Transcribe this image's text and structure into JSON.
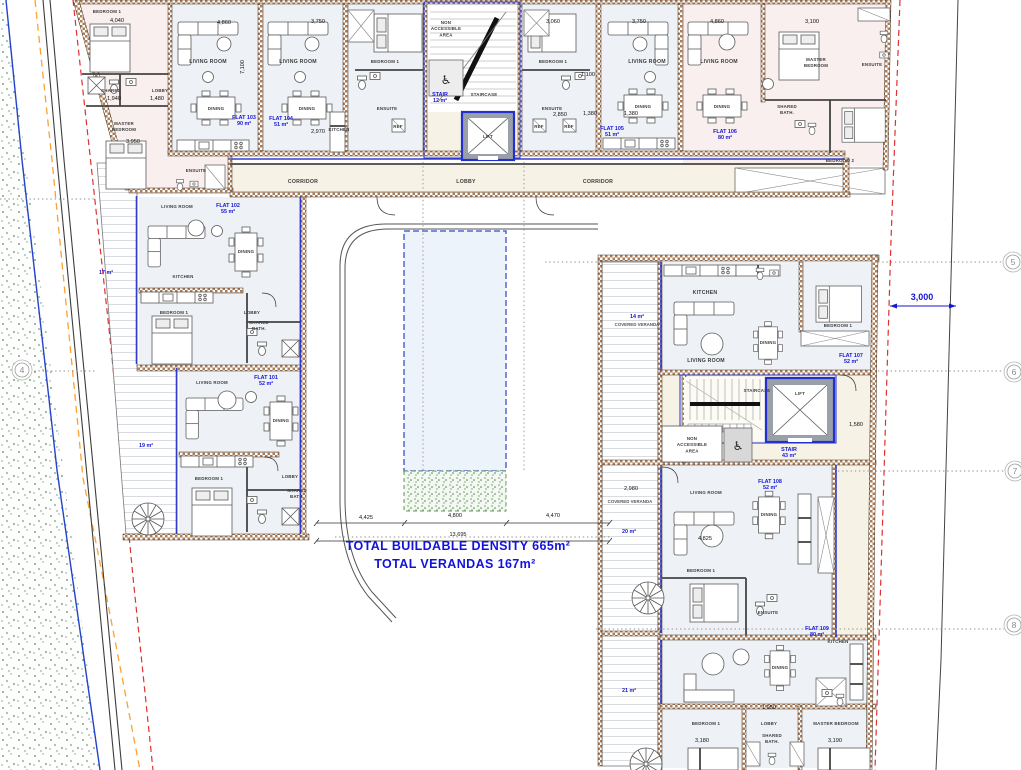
{
  "plan": {
    "totals": {
      "buildable_density": "TOTAL BUILDABLE DENSITY 665m²",
      "verandas": "TOTAL VERANDAS 167m²"
    },
    "flats": [
      {
        "name": "FLAT 101",
        "area": "52 m²"
      },
      {
        "name": "FLAT 102",
        "area": "55 m²"
      },
      {
        "name": "FLAT 103",
        "area": "90 m²"
      },
      {
        "name": "FLAT 104",
        "area": "51 m²"
      },
      {
        "name": "FLAT 105",
        "area": "51 m²"
      },
      {
        "name": "FLAT 106",
        "area": "80 m²"
      },
      {
        "name": "FLAT 107",
        "area": "52 m²"
      },
      {
        "name": "FLAT 108",
        "area": "52 m²"
      },
      {
        "name": "FLAT 109",
        "area": "80 m²"
      }
    ],
    "colors": {
      "accent_blue": "#1616d6",
      "wall_brown": "#ad7d57",
      "boundary_blue": "#2244cc",
      "boundary_orange": "#ffa030",
      "boundary_red": "#e03030",
      "grass_green": "#5d8f55"
    }
  },
  "grid_bubbles": [
    {
      "n": "4",
      "x": 22,
      "y": 370
    },
    {
      "n": "5",
      "x": 1013,
      "y": 262
    },
    {
      "n": "6",
      "x": 1014,
      "y": 372
    },
    {
      "n": "7",
      "x": 1015,
      "y": 471
    },
    {
      "n": "8",
      "x": 1014,
      "y": 625
    }
  ],
  "annotations": [
    {
      "id": "label-bedroom1-flat103",
      "text": "BEDROOM 1",
      "x": 107,
      "y": 13,
      "cls": "tiny"
    },
    {
      "id": "label-shared-flat103",
      "text": "SHARED",
      "x": 111,
      "y": 92,
      "cls": "tiny"
    },
    {
      "id": "label-lobby-flat103",
      "text": "LOBBY",
      "x": 160,
      "y": 92,
      "cls": "tiny"
    },
    {
      "id": "label-master-flat103",
      "text": "MASTER\nBEDROOM",
      "x": 124,
      "y": 125,
      "cls": "tiny"
    },
    {
      "id": "label-ensuite-flat103",
      "text": "ENSUITE",
      "x": 196,
      "y": 172,
      "cls": "tiny"
    },
    {
      "id": "label-living-flat103",
      "text": "LIVING ROOM",
      "x": 208,
      "y": 63,
      "cls": "room"
    },
    {
      "id": "label-living-flat104",
      "text": "LIVING ROOM",
      "x": 298,
      "y": 63,
      "cls": "room"
    },
    {
      "id": "label-dining-flat103",
      "text": "DINING",
      "x": 216,
      "y": 110,
      "cls": "tiny"
    },
    {
      "id": "label-dining-flat104",
      "text": "DINING",
      "x": 307,
      "y": 110,
      "cls": "tiny"
    },
    {
      "id": "label-flat-103",
      "text": "FLAT 103\n90 m²",
      "x": 244,
      "y": 119,
      "cls": "flat"
    },
    {
      "id": "label-flat-104",
      "text": "FLAT 104\n51 m²",
      "x": 281,
      "y": 120,
      "cls": "flat"
    },
    {
      "id": "label-kitchen-flat104",
      "text": "KITCHEN",
      "x": 339,
      "y": 131,
      "cls": "tiny"
    },
    {
      "id": "label-bedroom1-flat104",
      "text": "BEDROOM 1",
      "x": 385,
      "y": 63,
      "cls": "tiny"
    },
    {
      "id": "label-ensuite-flat104",
      "text": "ENSUITE",
      "x": 387,
      "y": 110,
      "cls": "tiny"
    },
    {
      "id": "label-ref-flat104",
      "text": "REF",
      "x": 398,
      "y": 128,
      "cls": "tiny"
    },
    {
      "id": "label-nonacc-top",
      "text": "NON\nACCESSIBLE\nAREA",
      "x": 446,
      "y": 24,
      "cls": "tiny"
    },
    {
      "id": "label-staircase-top",
      "text": "STAIRCASE",
      "x": 484,
      "y": 96,
      "cls": "tiny"
    },
    {
      "id": "label-stair-top",
      "text": "STAIR\n12 m²",
      "x": 440,
      "y": 96,
      "cls": "flat"
    },
    {
      "id": "label-lift-top",
      "text": "LIFT",
      "x": 488,
      "y": 138,
      "cls": "tiny"
    },
    {
      "id": "label-bedroom1-flat105",
      "text": "BEDROOM 1",
      "x": 553,
      "y": 63,
      "cls": "tiny"
    },
    {
      "id": "label-ensuite-flat105",
      "text": "ENSUITE",
      "x": 552,
      "y": 110,
      "cls": "tiny"
    },
    {
      "id": "label-ref1-flat105",
      "text": "REF",
      "x": 539,
      "y": 128,
      "cls": "tiny"
    },
    {
      "id": "label-ref2-flat105",
      "text": "REF",
      "x": 569,
      "y": 128,
      "cls": "tiny"
    },
    {
      "id": "label-living-flat105",
      "text": "LIVING ROOM",
      "x": 647,
      "y": 63,
      "cls": "room"
    },
    {
      "id": "label-dining-flat105",
      "text": "DINING",
      "x": 643,
      "y": 108,
      "cls": "tiny"
    },
    {
      "id": "label-flat-105",
      "text": "FLAT 105\n51 m²",
      "x": 612,
      "y": 130,
      "cls": "flat"
    },
    {
      "id": "label-living-flat106",
      "text": "LIVING ROOM",
      "x": 719,
      "y": 63,
      "cls": "room"
    },
    {
      "id": "label-dining-flat106",
      "text": "DINING",
      "x": 722,
      "y": 108,
      "cls": "tiny"
    },
    {
      "id": "label-flat-106",
      "text": "FLAT 106\n80 m²",
      "x": 725,
      "y": 133,
      "cls": "flat"
    },
    {
      "id": "label-master-flat106",
      "text": "MASTER\nBEDROOM",
      "x": 816,
      "y": 61,
      "cls": "tiny"
    },
    {
      "id": "label-ensuite-flat106",
      "text": "ENSUITE",
      "x": 872,
      "y": 66,
      "cls": "tiny"
    },
    {
      "id": "label-sharedbath-flat106",
      "text": "SHARED\nBATH.",
      "x": 787,
      "y": 108,
      "cls": "tiny"
    },
    {
      "id": "label-bedroom2-flat106",
      "text": "BEDROOM 2",
      "x": 840,
      "y": 162,
      "cls": "tiny"
    },
    {
      "id": "label-corridor-left",
      "text": "CORRIDOR",
      "x": 303,
      "y": 183,
      "cls": "room"
    },
    {
      "id": "label-lobby-center",
      "text": "LOBBY",
      "x": 466,
      "y": 183,
      "cls": "room"
    },
    {
      "id": "label-corridor-right",
      "text": "CORRIDOR",
      "x": 598,
      "y": 183,
      "cls": "room"
    },
    {
      "id": "label-living-flat102",
      "text": "LIVING ROOM",
      "x": 177,
      "y": 208,
      "cls": "tiny"
    },
    {
      "id": "label-flat-102",
      "text": "FLAT 102\n55 m²",
      "x": 228,
      "y": 207,
      "cls": "flat"
    },
    {
      "id": "label-dining-flat102",
      "text": "DINING",
      "x": 246,
      "y": 253,
      "cls": "tiny"
    },
    {
      "id": "label-kitchen-flat102",
      "text": "KITCHEN",
      "x": 183,
      "y": 278,
      "cls": "tiny"
    },
    {
      "id": "label-bedroom1-flat102",
      "text": "BEDROOM 1",
      "x": 174,
      "y": 314,
      "cls": "tiny"
    },
    {
      "id": "label-lobby-flat102",
      "text": "LOBBY",
      "x": 252,
      "y": 314,
      "cls": "tiny"
    },
    {
      "id": "label-sharedbath-flat102",
      "text": "SHARED\nBATH.",
      "x": 259,
      "y": 324,
      "cls": "tiny"
    },
    {
      "id": "label-veranda-17",
      "text": "17 m²",
      "x": 106,
      "y": 274,
      "cls": "flat"
    },
    {
      "id": "label-flat-101",
      "text": "FLAT 101\n52 m²",
      "x": 266,
      "y": 379,
      "cls": "flat"
    },
    {
      "id": "label-living-flat101",
      "text": "LIVING ROOM",
      "x": 212,
      "y": 384,
      "cls": "tiny"
    },
    {
      "id": "label-dining-flat101",
      "text": "DINING",
      "x": 281,
      "y": 422,
      "cls": "tiny"
    },
    {
      "id": "label-veranda-19",
      "text": "19 m²",
      "x": 146,
      "y": 447,
      "cls": "flat"
    },
    {
      "id": "label-bedroom1-flat101",
      "text": "BEDROOM 1",
      "x": 209,
      "y": 480,
      "cls": "tiny"
    },
    {
      "id": "label-lobby-flat101",
      "text": "LOBBY",
      "x": 290,
      "y": 478,
      "cls": "tiny"
    },
    {
      "id": "label-sharedbath-flat101",
      "text": "SHARED\nBATH.",
      "x": 297,
      "y": 492,
      "cls": "tiny"
    },
    {
      "id": "label-kitchen-flat107",
      "text": "KITCHEN",
      "x": 705,
      "y": 294,
      "cls": "room"
    },
    {
      "id": "label-living-flat107",
      "text": "LIVING ROOM",
      "x": 706,
      "y": 362,
      "cls": "room"
    },
    {
      "id": "label-dining-flat107",
      "text": "DINING",
      "x": 768,
      "y": 344,
      "cls": "tiny"
    },
    {
      "id": "label-bedroom1-flat107",
      "text": "BEDROOM 1",
      "x": 838,
      "y": 327,
      "cls": "tiny"
    },
    {
      "id": "label-flat-107",
      "text": "FLAT 107\n52 m²",
      "x": 851,
      "y": 357,
      "cls": "flat"
    },
    {
      "id": "label-veranda-14",
      "text": "14 m²",
      "x": 637,
      "y": 318,
      "cls": "flat"
    },
    {
      "id": "label-coveredveranda-14",
      "text": "COVERED VERANDA",
      "x": 637,
      "y": 326,
      "cls": "gray"
    },
    {
      "id": "label-staircase-right",
      "text": "STAIRCASE",
      "x": 757,
      "y": 392,
      "cls": "tiny"
    },
    {
      "id": "label-lift-right",
      "text": "LIFT",
      "x": 800,
      "y": 395,
      "cls": "tiny"
    },
    {
      "id": "label-nonacc-right",
      "text": "NON\nACCESSIBLE\nAREA",
      "x": 692,
      "y": 440,
      "cls": "tiny"
    },
    {
      "id": "label-stair-right",
      "text": "STAIR\n43 m²",
      "x": 789,
      "y": 451,
      "cls": "flat"
    },
    {
      "id": "label-flat-108",
      "text": "FLAT 108\n52 m²",
      "x": 770,
      "y": 483,
      "cls": "flat"
    },
    {
      "id": "label-living-flat108",
      "text": "LIVING ROOM",
      "x": 706,
      "y": 494,
      "cls": "tiny"
    },
    {
      "id": "label-dining-flat108",
      "text": "DINING",
      "x": 769,
      "y": 516,
      "cls": "tiny"
    },
    {
      "id": "label-dim-2980",
      "text": "2,980",
      "x": 631,
      "y": 490,
      "cls": "dim"
    },
    {
      "id": "label-coveredveranda-20",
      "text": "COVERED VERANDA",
      "x": 630,
      "y": 503,
      "cls": "gray"
    },
    {
      "id": "label-veranda-20",
      "text": "20 m²",
      "x": 629,
      "y": 533,
      "cls": "flat"
    },
    {
      "id": "label-bedroom1-flat108",
      "text": "BEDROOM 1",
      "x": 701,
      "y": 572,
      "cls": "tiny"
    },
    {
      "id": "label-ensuite-flat108",
      "text": "ENSUITE",
      "x": 768,
      "y": 614,
      "cls": "tiny"
    },
    {
      "id": "label-flat-109",
      "text": "FLAT 109\n80 m²",
      "x": 817,
      "y": 630,
      "cls": "flat"
    },
    {
      "id": "label-kitchen-flat109",
      "text": "KITCHEN",
      "x": 838,
      "y": 643,
      "cls": "tiny"
    },
    {
      "id": "label-dining-flat109",
      "text": "DINING",
      "x": 780,
      "y": 669,
      "cls": "tiny"
    },
    {
      "id": "label-veranda-21",
      "text": "21 m²",
      "x": 629,
      "y": 692,
      "cls": "flat"
    },
    {
      "id": "label-bedroom1-flat109",
      "text": "BEDROOM 1",
      "x": 706,
      "y": 725,
      "cls": "tiny"
    },
    {
      "id": "label-lobby-flat109",
      "text": "LOBBY",
      "x": 769,
      "y": 725,
      "cls": "tiny"
    },
    {
      "id": "label-master-flat109",
      "text": "MASTER BEDROOM",
      "x": 836,
      "y": 725,
      "cls": "tiny"
    },
    {
      "id": "label-sharedbath-flat109",
      "text": "SHARED\nBATH.",
      "x": 772,
      "y": 737,
      "cls": "tiny"
    },
    {
      "id": "label-total-density",
      "text": "TOTAL BUILDABLE DENSITY 665m²",
      "x": 458,
      "y": 550,
      "cls": "total"
    },
    {
      "id": "label-total-verandas",
      "text": "TOTAL VERANDAS 167m²",
      "x": 455,
      "y": 568,
      "cls": "total"
    },
    {
      "id": "dim-4040",
      "text": "4,040",
      "x": 117,
      "y": 22,
      "cls": "dim"
    },
    {
      "id": "dim-4860-a",
      "text": "4,860",
      "x": 224,
      "y": 24,
      "cls": "dim"
    },
    {
      "id": "dim-3750-a",
      "text": "3,750",
      "x": 318,
      "y": 23,
      "cls": "dim"
    },
    {
      "id": "dim-3060",
      "text": "3,060",
      "x": 553,
      "y": 23,
      "cls": "dim"
    },
    {
      "id": "dim-3750-b",
      "text": "3,750",
      "x": 639,
      "y": 23,
      "cls": "dim"
    },
    {
      "id": "dim-4860-b",
      "text": "4,860",
      "x": 717,
      "y": 23,
      "cls": "dim"
    },
    {
      "id": "dim-3100",
      "text": "3,100",
      "x": 812,
      "y": 23,
      "cls": "dim"
    },
    {
      "id": "dim-7100",
      "text": "7,100",
      "x": 244,
      "y": 67,
      "cls": "dim",
      "rot": -90
    },
    {
      "id": "dim-1940",
      "text": "1,940",
      "x": 114,
      "y": 100,
      "cls": "dim"
    },
    {
      "id": "dim-1480",
      "text": "1,480",
      "x": 157,
      "y": 100,
      "cls": "dim"
    },
    {
      "id": "dim-3950",
      "text": "3,950",
      "x": 133,
      "y": 143,
      "cls": "dim"
    },
    {
      "id": "dim-2970",
      "text": "2,970",
      "x": 318,
      "y": 133,
      "cls": "dim"
    },
    {
      "id": "dim-1100",
      "text": "1,100",
      "x": 588,
      "y": 76,
      "cls": "dim"
    },
    {
      "id": "dim-2850",
      "text": "2,850",
      "x": 560,
      "y": 116,
      "cls": "dim"
    },
    {
      "id": "dim-1380-a",
      "text": "1,380",
      "x": 590,
      "y": 115,
      "cls": "dim"
    },
    {
      "id": "dim-1380-b",
      "text": "1,380",
      "x": 631,
      "y": 115,
      "cls": "dim"
    },
    {
      "id": "dim-4425",
      "text": "4,425",
      "x": 366,
      "y": 519,
      "cls": "dim"
    },
    {
      "id": "dim-4800",
      "text": "4,800",
      "x": 455,
      "y": 517,
      "cls": "dim"
    },
    {
      "id": "dim-4470",
      "text": "4,470",
      "x": 553,
      "y": 517,
      "cls": "dim"
    },
    {
      "id": "dim-13695",
      "text": "13,695",
      "x": 458,
      "y": 536,
      "cls": "dim"
    },
    {
      "id": "dim-3000",
      "text": "3,000",
      "x": 922,
      "y": 300,
      "cls": "dimb"
    },
    {
      "id": "dim-1580",
      "text": "1,580",
      "x": 856,
      "y": 426,
      "cls": "dim"
    },
    {
      "id": "dim-4825",
      "text": "4,825",
      "x": 705,
      "y": 540,
      "cls": "dim"
    },
    {
      "id": "dim-1950",
      "text": "1,950",
      "x": 769,
      "y": 709,
      "cls": "dim"
    },
    {
      "id": "dim-3180",
      "text": "3,180",
      "x": 702,
      "y": 742,
      "cls": "dim"
    },
    {
      "id": "dim-3190",
      "text": "3,190",
      "x": 835,
      "y": 742,
      "cls": "dim"
    }
  ]
}
